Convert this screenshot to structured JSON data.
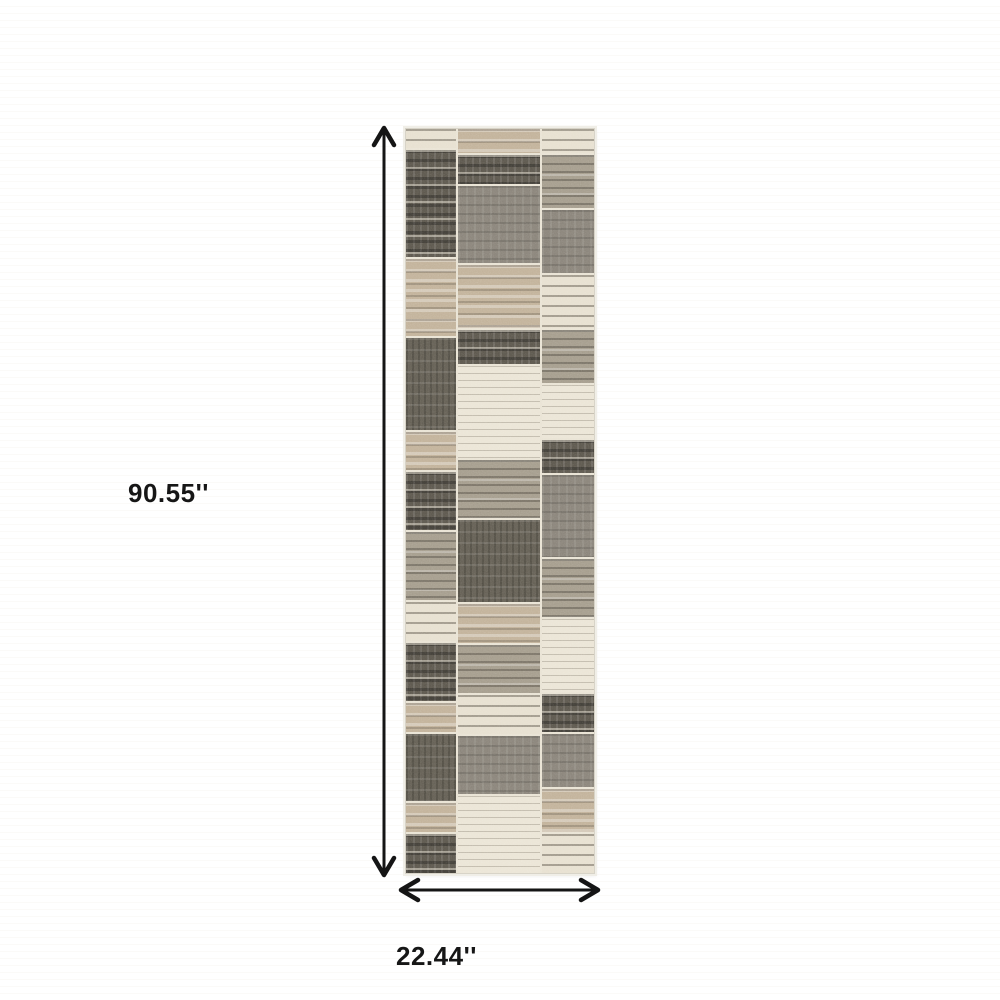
{
  "diagram": {
    "type": "product-dimension-diagram",
    "product": "grey and tan patchwork striped runner rug",
    "height": {
      "label": "90.55''"
    },
    "width": {
      "label": "22.44''"
    }
  },
  "colors": {
    "background": "#ffffff",
    "arrow": "#151515",
    "label_text": "#161616",
    "rug_seam": "#e9e3d4",
    "rug_edge": "#d8d4c8",
    "charcoal": "#5c574d",
    "dark_gray": "#645f54",
    "gray": "#8a847a",
    "warm_gray": "#a59d8d",
    "beige": "#c2b29a",
    "cream": "#e7e0d0",
    "off_white": "#ebe5d6"
  },
  "rug": {
    "columns": [
      {
        "width": 27,
        "patches": [
          {
            "h": 20,
            "style": "cream-stripes"
          },
          {
            "h": 110,
            "style": "charcoal-stripes"
          },
          {
            "h": 80,
            "style": "beige-stripes"
          },
          {
            "h": 95,
            "style": "charcoal-block"
          },
          {
            "h": 40,
            "style": "beige-stripes"
          },
          {
            "h": 60,
            "style": "charcoal-stripes"
          },
          {
            "h": 70,
            "style": "gray-stripes"
          },
          {
            "h": 40,
            "style": "cream-stripes"
          },
          {
            "h": 60,
            "style": "charcoal-stripes"
          },
          {
            "h": 30,
            "style": "beige-stripes"
          },
          {
            "h": 70,
            "style": "charcoal-block"
          },
          {
            "h": 30,
            "style": "beige-stripes"
          },
          {
            "h": 40,
            "style": "charcoal-stripes"
          }
        ]
      },
      {
        "width": 45,
        "patches": [
          {
            "h": 25,
            "style": "beige-stripes"
          },
          {
            "h": 30,
            "style": "charcoal-stripes"
          },
          {
            "h": 80,
            "style": "gray-block"
          },
          {
            "h": 65,
            "style": "beige-stripes"
          },
          {
            "h": 35,
            "style": "charcoal-stripes"
          },
          {
            "h": 95,
            "style": "cream-fine"
          },
          {
            "h": 60,
            "style": "gray-stripes"
          },
          {
            "h": 85,
            "style": "charcoal-block"
          },
          {
            "h": 40,
            "style": "beige-stripes"
          },
          {
            "h": 50,
            "style": "gray-stripes"
          },
          {
            "h": 40,
            "style": "cream-stripes"
          },
          {
            "h": 60,
            "style": "gray-block"
          },
          {
            "h": 80,
            "style": "cream-fine"
          }
        ]
      },
      {
        "width": 28,
        "patches": [
          {
            "h": 25,
            "style": "cream-stripes"
          },
          {
            "h": 55,
            "style": "gray-stripes"
          },
          {
            "h": 65,
            "style": "gray-block"
          },
          {
            "h": 55,
            "style": "cream-stripes"
          },
          {
            "h": 55,
            "style": "gray-stripes"
          },
          {
            "h": 55,
            "style": "cream-fine"
          },
          {
            "h": 35,
            "style": "charcoal-stripes"
          },
          {
            "h": 85,
            "style": "gray-block"
          },
          {
            "h": 60,
            "style": "gray-stripes"
          },
          {
            "h": 75,
            "style": "cream-fine"
          },
          {
            "h": 40,
            "style": "charcoal-stripes"
          },
          {
            "h": 55,
            "style": "gray-block"
          },
          {
            "h": 45,
            "style": "beige-stripes"
          },
          {
            "h": 40,
            "style": "cream-stripes"
          }
        ]
      }
    ]
  }
}
